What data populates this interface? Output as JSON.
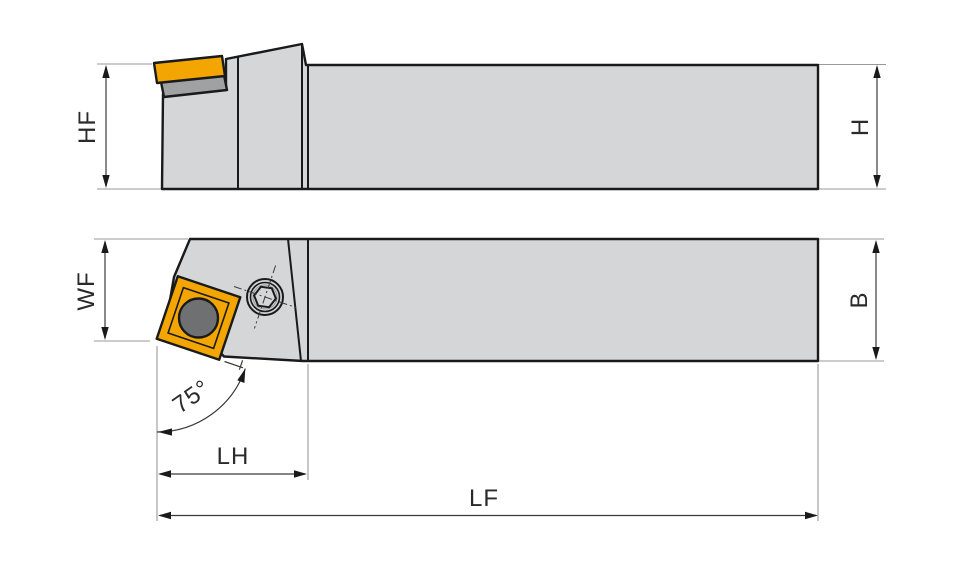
{
  "drawing": {
    "type": "toolholder-technical-drawing",
    "views": [
      "side-elevation",
      "plan-view"
    ]
  },
  "dimensions": {
    "hf": "HF",
    "h": "H",
    "wf": "WF",
    "b": "B",
    "lh": "LH",
    "lf": "LF",
    "lead_angle": "75°"
  },
  "colors": {
    "body": "#d4d6d8",
    "shim": "#9fa1a3",
    "insert": "#f3a602",
    "insert-inner": "#f7b005",
    "hole": "#6e7072",
    "hex": "#5e6062",
    "outline": "#1a1a1a",
    "dim": "#3a3a3a",
    "ext": "#999999",
    "text": "#2a2a2a"
  }
}
